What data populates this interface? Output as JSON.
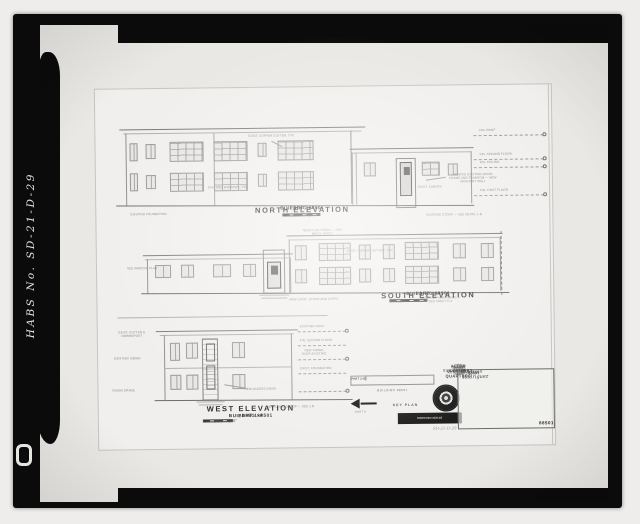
{
  "film": {
    "habs_label": "HABS No. SD-21-D-29"
  },
  "sheet": {
    "north": {
      "title": "NORTH ELEVATION",
      "building": "BUILDING 88501",
      "part": "PART 1-A",
      "scale": "SCALE  1/8\" = 1'-0\"",
      "levels": [
        "FIN. ROOF",
        "FIN. SECOND FLOOR",
        "FIN. CEILING",
        "FIN. FIRST FLOOR"
      ],
      "notes": {
        "gutter": "EXIST. COPPER GUTTER, TYP.",
        "windows": "EXISTING WINDOWS, TYP.",
        "foundation": "EXISTING FOUNDATION",
        "canopy": "EXIST. CANOPY",
        "remove_door": "REMOVE EXISTING DOOR, FRAME AND TRANSOM — NEW MASONRY WALL",
        "stoop": "EXISTING STOOP — SEE DETAIL 1-B"
      }
    },
    "south": {
      "title": "SOUTH ELEVATION",
      "building": "BUILDING 88501",
      "part": "PART 1-A",
      "scale": "SCALE  1/8\" = 1'-0\"",
      "notes": {
        "window_plan": "SEE WINDOW PLAN",
        "stack": "NEW FLUE STACK — SEE MECH. DWGS.",
        "gutter": "EXIST. COPPER GUTTER, TYP.",
        "stoop": "NEW CONC. STOOP AND STEPS",
        "siding": "MATCHING NEW SIDING — SEE SHEET C-2"
      }
    },
    "west": {
      "title": "WEST ELEVATION",
      "building": "BUILDING 88501",
      "part": "PART 1-A",
      "scale": "SCALE  1/8\" = 1'-0\"",
      "notes": {
        "gutter": "EXIST. GUTTER & DOWNSPOUT",
        "siding_l": "EXISTING SIDING",
        "grade": "FINISH GRADE",
        "roof": "EXISTING ROOF",
        "second": "FIN. SECOND FLOOR",
        "siding_r": "NEW SIDING OVER EXISTING",
        "found": "EXIST. FOUNDATION",
        "stoop": "NEW CONC. STOOP — SEE 1-B",
        "access": "NEW ACCESS DOOR"
      }
    },
    "key_plan": {
      "parts": [
        "PART 1-A",
        "PART 1-B",
        "PART 1-C"
      ],
      "building": "BUILDING 88501",
      "label": "KEY PLAN",
      "north": "NORTH"
    },
    "stamp": {
      "line1": "REPRODUCED AT",
      "line2": "REDUCED SCALE"
    },
    "title_block": {
      "revisions": "REVISIONS",
      "firm1": "ARCHITECTS – ENGINEERS",
      "firm2": "RAPID CITY, SOUTH DAKOTA",
      "agency1": "U.S. ARMY ENGINEER DISTRICT",
      "agency2": "CORPS OF ENGINEERS",
      "agency3": "OMAHA, NEBRASKA",
      "project": "ALTER OFFICERS QUARTERS",
      "location": "ELLSWORTH AIR FORCE BASE — SOUTH DAKOTA",
      "sheet_title": "ELEVATIONS",
      "building": "BUILDING 88501",
      "roles": [
        "DES.",
        "DR.",
        "CH.",
        "APP."
      ],
      "signature": "E. Rodriguez",
      "signature2": "W. Morrison",
      "drawing_no": "88501",
      "pencil_note": "SD-21-D-29"
    }
  }
}
